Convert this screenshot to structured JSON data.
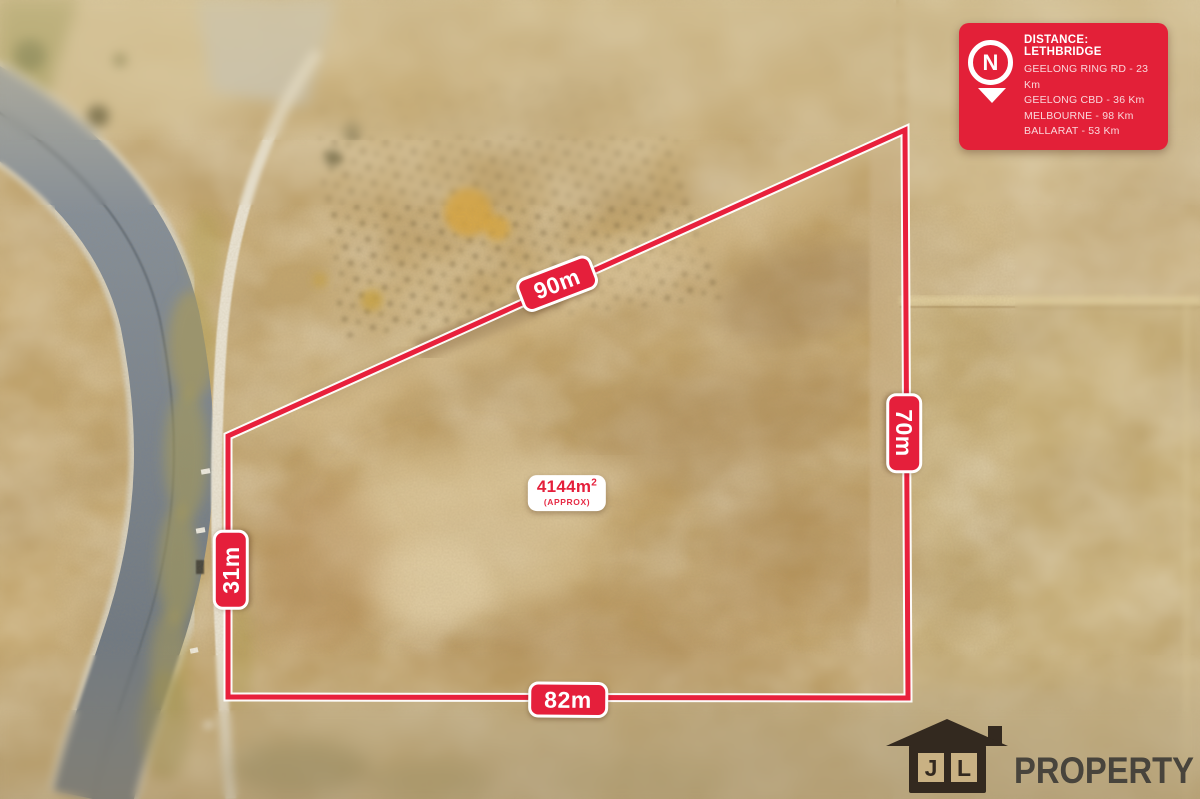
{
  "annotations": {
    "dimensions": [
      {
        "side": "top",
        "label": "90m"
      },
      {
        "side": "right",
        "label": "70m"
      },
      {
        "side": "left",
        "label": "31m"
      },
      {
        "side": "bottom",
        "label": "82m"
      }
    ],
    "area": {
      "value": "4144m",
      "sup": "2",
      "qualifier": "(APPROX)"
    }
  },
  "distance_card": {
    "title": "DISTANCE: LETHBRIDGE",
    "north_label": "N",
    "items": [
      "GEELONG RING RD - 23 Km",
      "GEELONG CBD - 36 Km",
      "MELBOURNE - 98 Km",
      "BALLARAT - 53 Km"
    ]
  },
  "logo": {
    "house_letters": [
      "J",
      "L"
    ],
    "name": "PROPERTY"
  },
  "colors": {
    "accent_red": "#e51f3b",
    "card_red": "#e32038",
    "boundary_casing": "#ffffff",
    "logo_house": "#33291f",
    "logo_text": "#48443c"
  }
}
